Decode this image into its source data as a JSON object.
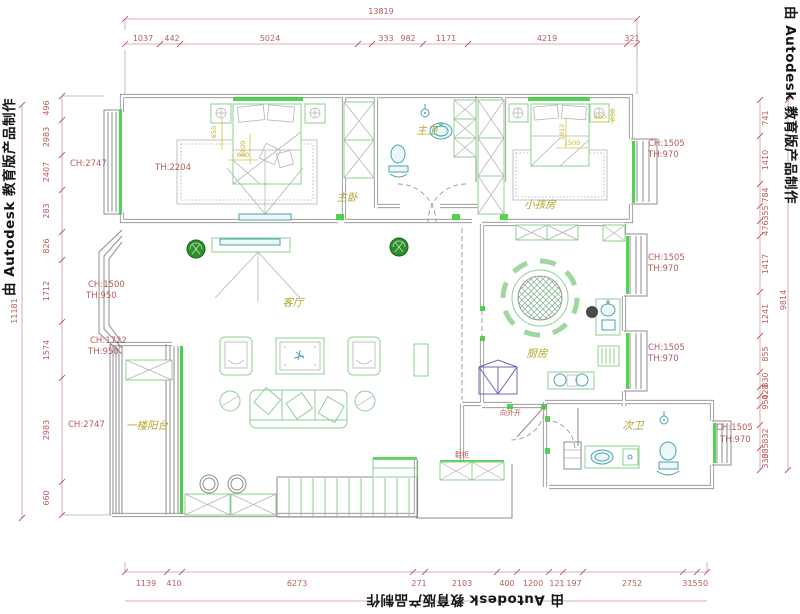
{
  "watermark": {
    "text": "由 Autodesk 教育版产品制作"
  },
  "colors": {
    "wall": "#8c8c8c",
    "furniture_green": "#8fd08f",
    "accent_green": "#3ecf3e",
    "dimension_red": "#b65c5c",
    "room_label_yellow": "#b5a32e",
    "fixture_teal": "#4aa3ad",
    "bed_dim_yellow": "#c9b62e"
  },
  "dimensions": {
    "top": {
      "total": "13819",
      "segments": [
        "1037",
        "442",
        "5024",
        "333",
        "982",
        "1171",
        "4219",
        "321"
      ]
    },
    "left": {
      "total": "11181",
      "segments": [
        "496",
        "2983",
        "2407",
        "283",
        "826",
        "1712",
        "1574",
        "2983",
        "660"
      ]
    },
    "right": {
      "total": "9814",
      "segments": [
        "741",
        "1410",
        "784",
        "355",
        "476",
        "1417",
        "1241",
        "855",
        "830",
        "428",
        "950",
        "832",
        "385",
        "330"
      ]
    },
    "bottom": {
      "segments": [
        "1139",
        "410",
        "6273",
        "271",
        "2103",
        "400",
        "1200",
        "121",
        "197",
        "2752",
        "315",
        "50"
      ]
    }
  },
  "rooms": {
    "master_bedroom": "主卧",
    "master_bath": "主卫",
    "kids_room": "小孩房",
    "living_room": "客厅",
    "kitchen": "厨房",
    "second_bath": "次卫",
    "ground_balcony": "一楼阳台"
  },
  "heights": {
    "ch2747": "CH:2747",
    "th2204": "TH:2204",
    "ch1500": "CH:1500",
    "th950": "TH:950",
    "ch1722": "CH:1722",
    "ch1505": "CH:1505",
    "th970": "TH:970"
  },
  "notes": {
    "door_swing": "向外开",
    "shoe_cabinet": "鞋柜"
  },
  "furniture_dims": {
    "master": [
      "650",
      "2100",
      "600"
    ],
    "kids": [
      "1500",
      "1912",
      "600",
      "650"
    ]
  }
}
